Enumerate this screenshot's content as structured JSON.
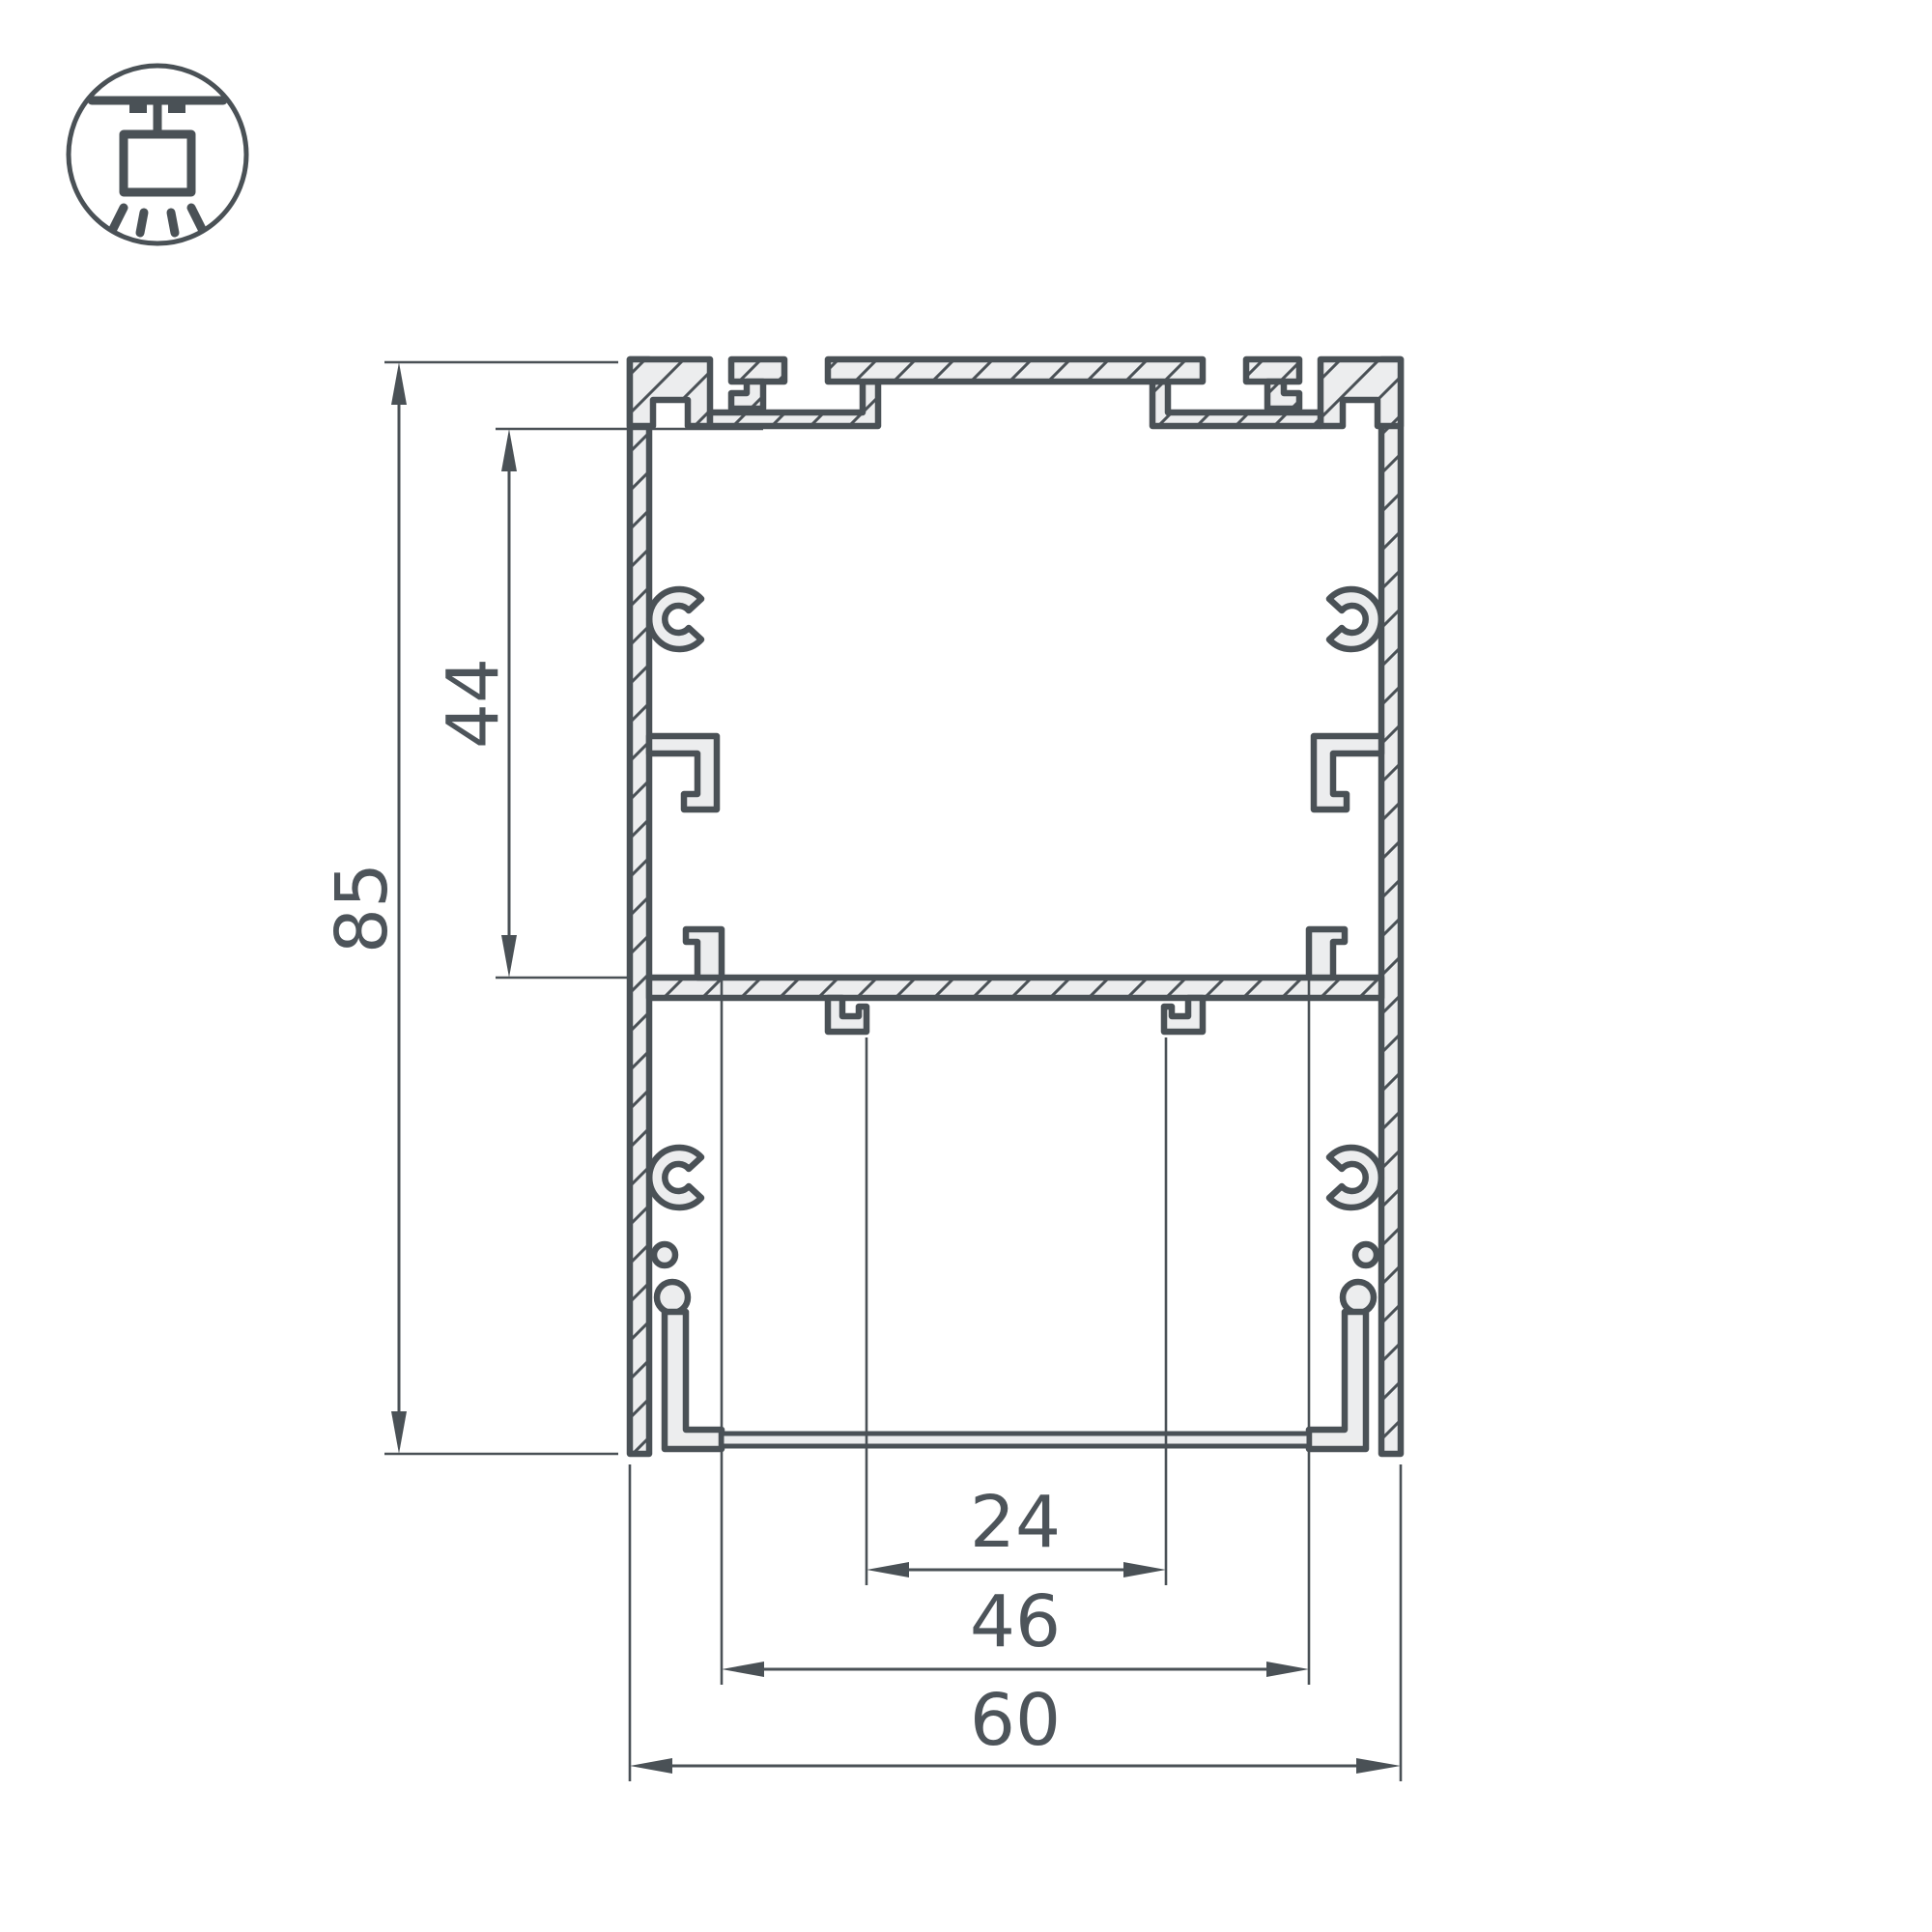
{
  "drawing": {
    "kind": "aluminium-profile-cross-section",
    "background": "#ffffff",
    "line_color": "#4a5156",
    "material_fill": "#ecedee",
    "icon": "pendant-mount",
    "dimensions": {
      "height_overall": "85",
      "height_upper_chamber": "44",
      "width_inner_slot": "24",
      "width_diffuser_opening": "46",
      "width_overall": "60"
    }
  }
}
